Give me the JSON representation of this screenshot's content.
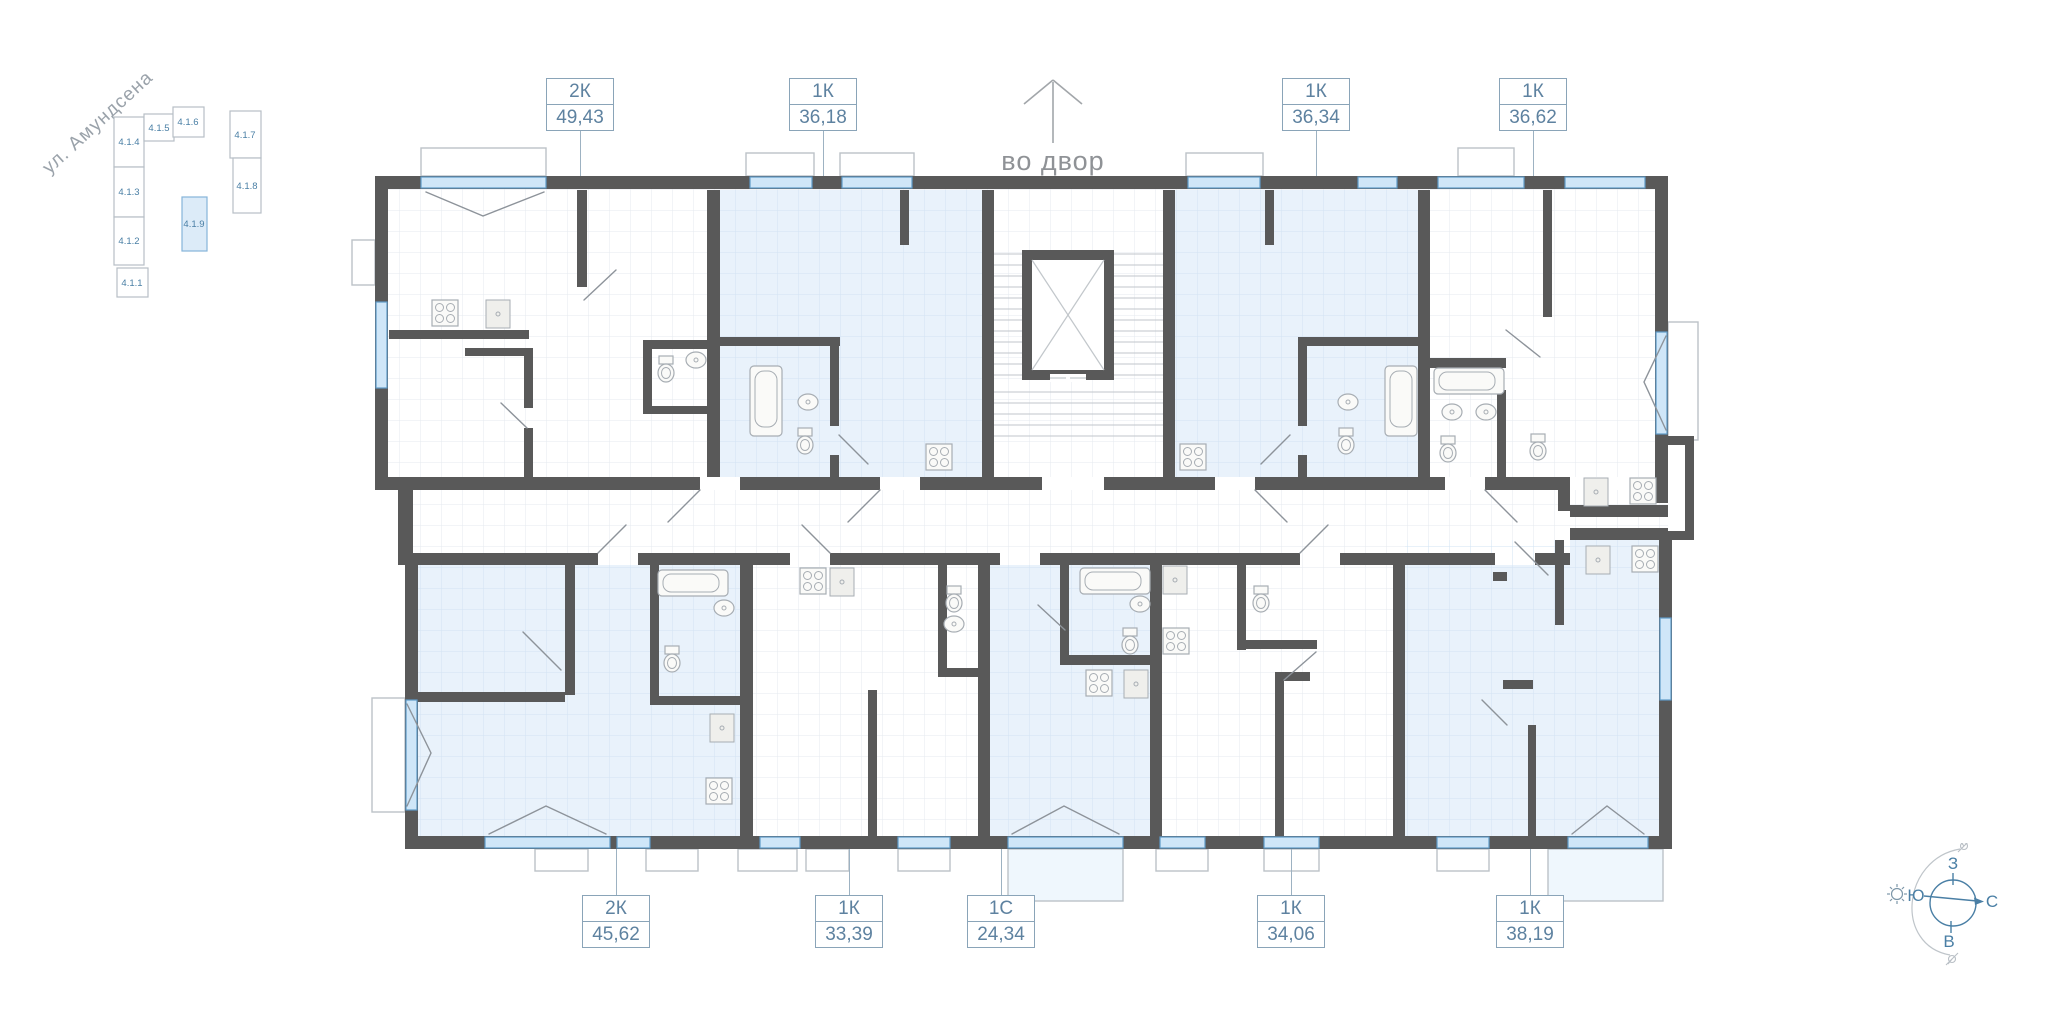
{
  "street": {
    "label": "ул. Амундсена"
  },
  "courtyard": {
    "label": "во двор"
  },
  "minimap": {
    "selected_id": "4.1.9",
    "buildings": [
      {
        "id": "4.1.4",
        "label": "4.1.4",
        "selected": false
      },
      {
        "id": "4.1.3",
        "label": "4.1.3",
        "selected": false
      },
      {
        "id": "4.1.2",
        "label": "4.1.2",
        "selected": false
      },
      {
        "id": "4.1.1",
        "label": "4.1.1",
        "selected": false
      },
      {
        "id": "4.1.5",
        "label": "4.1.5",
        "selected": false
      },
      {
        "id": "4.1.6",
        "label": "4.1.6",
        "selected": false
      },
      {
        "id": "4.1.7",
        "label": "4.1.7",
        "selected": false
      },
      {
        "id": "4.1.8",
        "label": "4.1.8",
        "selected": false
      },
      {
        "id": "4.1.9",
        "label": "4.1.9",
        "selected": true
      }
    ]
  },
  "apartments": [
    {
      "id": "top-1",
      "type": "2К",
      "area": "49,43",
      "row": "top",
      "highlighted": false
    },
    {
      "id": "top-2",
      "type": "1К",
      "area": "36,18",
      "row": "top",
      "highlighted": true
    },
    {
      "id": "top-3",
      "type": "1К",
      "area": "36,34",
      "row": "top",
      "highlighted": true
    },
    {
      "id": "top-4",
      "type": "1К",
      "area": "36,62",
      "row": "top",
      "highlighted": false
    },
    {
      "id": "bottom-1",
      "type": "2К",
      "area": "45,62",
      "row": "bottom",
      "highlighted": true
    },
    {
      "id": "bottom-2",
      "type": "1К",
      "area": "33,39",
      "row": "bottom",
      "highlighted": false
    },
    {
      "id": "bottom-3",
      "type": "1С",
      "area": "24,34",
      "row": "bottom",
      "highlighted": true
    },
    {
      "id": "bottom-4",
      "type": "1К",
      "area": "34,06",
      "row": "bottom",
      "highlighted": false
    },
    {
      "id": "bottom-5",
      "type": "1К",
      "area": "38,19",
      "row": "bottom",
      "highlighted": true
    }
  ],
  "compass": {
    "west": "З",
    "south": "Ю",
    "north": "С",
    "east": "В"
  },
  "colors": {
    "wall": "#595959",
    "window_fill": "#cfe6f8",
    "window_frame": "#5e9bc8",
    "room_highlight": "#e9f2fb",
    "label_text": "#5e82a0",
    "label_border": "#8aa4b8",
    "accent": "#4a7fa5"
  }
}
